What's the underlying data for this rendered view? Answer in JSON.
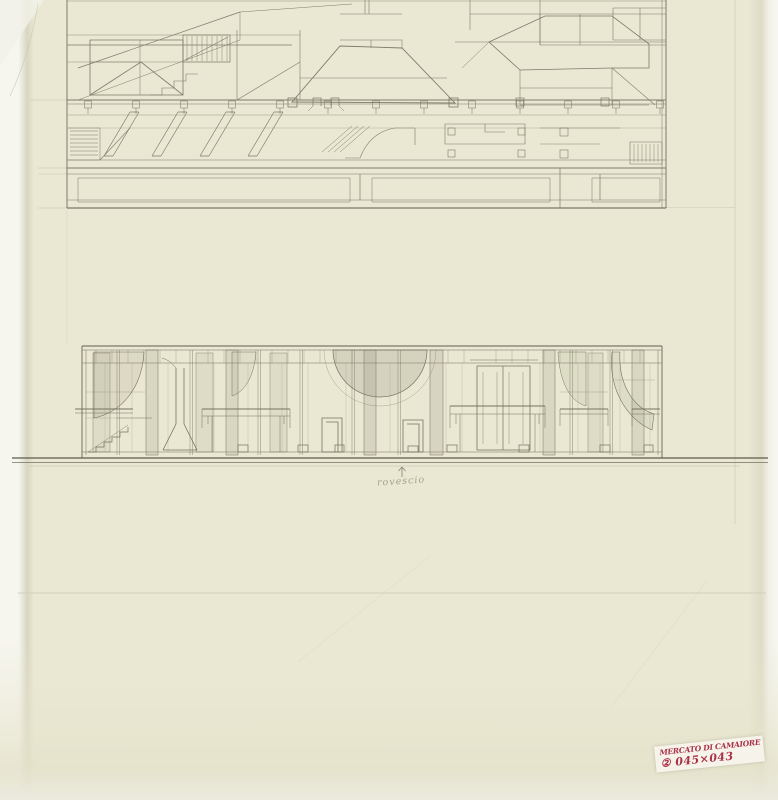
{
  "sheet": {
    "colors": {
      "paper": "#eae8d2",
      "paper_edge": "#f6f5ee",
      "pencil": "#7d7b68",
      "pencil_dark": "#5d5b4d",
      "pencil_faint": "#b9b6a3",
      "stamp_ink": "#a93248",
      "stamp_label_bg": "#f6f3ea"
    },
    "drawings": {
      "top": "floor-plan",
      "middle": "longitudinal-section"
    },
    "annotation": {
      "arrow_glyph": "↑",
      "label": "rovescio"
    },
    "stamp": {
      "line1": "MERCATO DI CAMAIORE",
      "line2": "② 045×043"
    }
  }
}
